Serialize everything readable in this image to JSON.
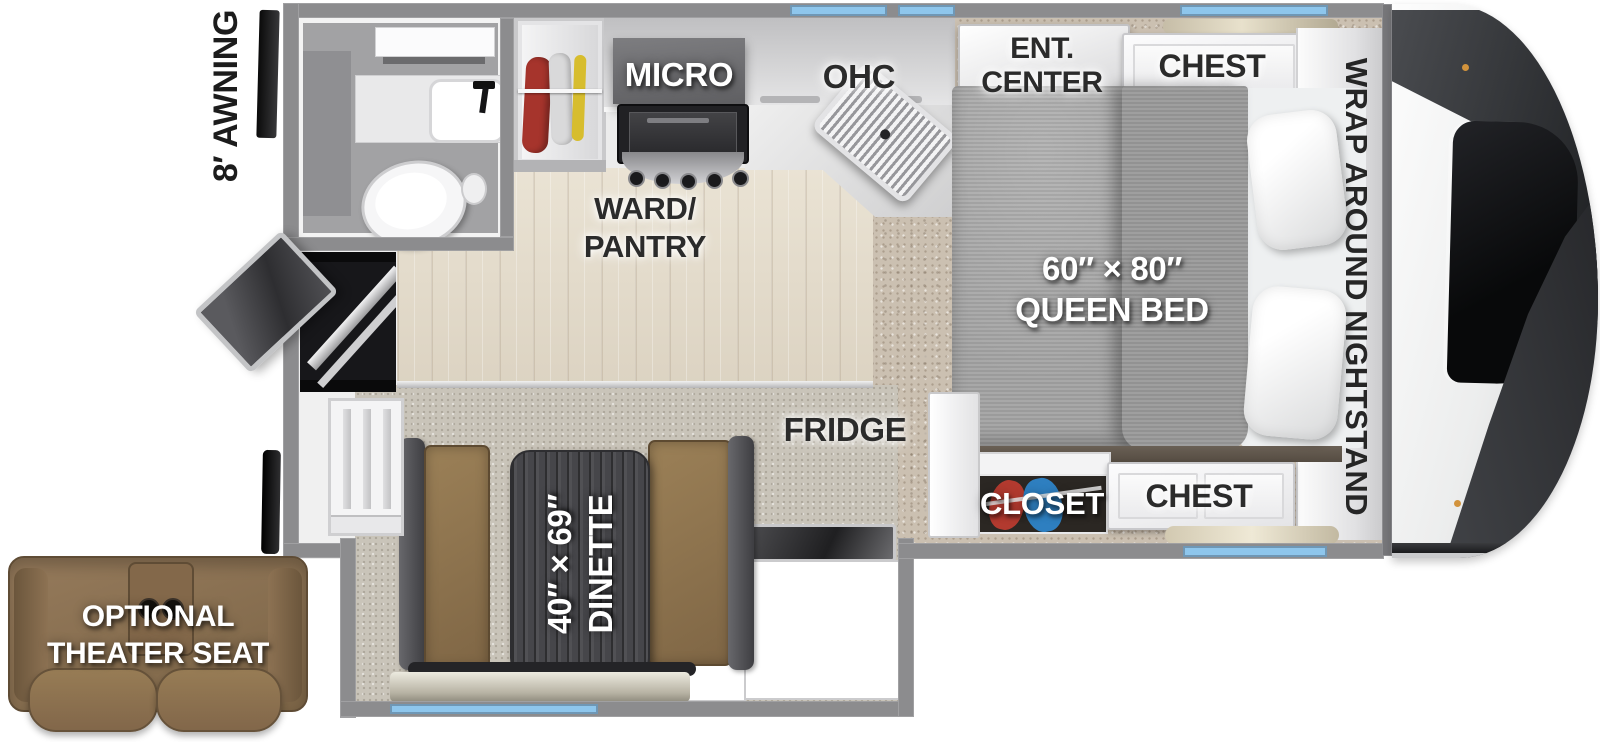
{
  "labels": {
    "awning": "8′ AWNING",
    "micro": "MICRO",
    "ohc": "OHC",
    "ward_line1": "WARD/",
    "ward_line2": "PANTRY",
    "ent_line1": "ENT.",
    "ent_line2": "CENTER",
    "chest_top": "CHEST",
    "chest_bottom": "CHEST",
    "closet": "CLOSET",
    "fridge": "FRIDGE",
    "bed_line1": "60″ × 80″",
    "bed_line2": "QUEEN BED",
    "nightstand": "WRAP AROUND NIGHTSTAND",
    "dinette_line1": "40″ × 69″",
    "dinette_line2": "DINETTE",
    "theater_line1": "OPTIONAL",
    "theater_line2": "THEATER SEAT"
  },
  "colors": {
    "wall_gray": "#8c8c8e",
    "window_blue": "#8ec6ec",
    "tv_blue": "#2b57b0",
    "wood_floor": "#e3dbcb",
    "carpet_tan": "#cbc0b1",
    "bench_brown": "#8f744e",
    "table_wood": "#46464a",
    "sofa_brown": "#8a7050",
    "closet_red": "#b23a2f",
    "closet_blue": "#2e7fc0",
    "label_dark": "#2b2b2b",
    "label_light": "#ffffff"
  }
}
